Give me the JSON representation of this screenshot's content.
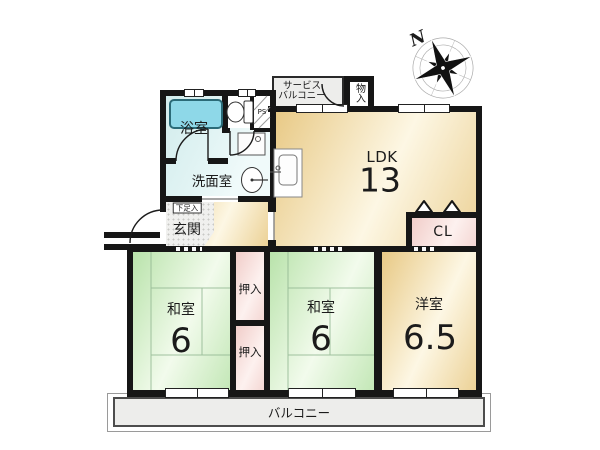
{
  "floorplan": {
    "compass": {
      "north_label": "N"
    },
    "rooms": {
      "bath": {
        "label": "浴室"
      },
      "washroom": {
        "label": "洗面室"
      },
      "ps": {
        "label": "PS"
      },
      "service_balcony": {
        "line1": "サービス",
        "line2": "バルコニー"
      },
      "storage": {
        "label": "物入"
      },
      "ldk": {
        "label": "LDK",
        "size": "13"
      },
      "shoe_box": {
        "label": "下足入"
      },
      "entrance": {
        "label": "玄関"
      },
      "closet": {
        "label": "CL"
      },
      "washitsu_left": {
        "label": "和室",
        "size": "6"
      },
      "oshiire_upper": {
        "label": "押入"
      },
      "oshiire_lower": {
        "label": "押入"
      },
      "washitsu_center": {
        "label": "和室",
        "size": "6"
      },
      "western_room": {
        "label": "洋室",
        "size": "6.5"
      },
      "balcony": {
        "label": "バルコニー"
      }
    },
    "colors": {
      "wall": "#161616",
      "tan1": "#e8c985",
      "tan2": "#fdf7e4",
      "green1": "#b9e3ab",
      "green2": "#f2fbec",
      "pink1": "#f1cdc9",
      "pink2": "#fdf1ef",
      "cyan": "#e2f4f4",
      "tub": "#8ed8e8",
      "gray": "#ededeb"
    }
  }
}
